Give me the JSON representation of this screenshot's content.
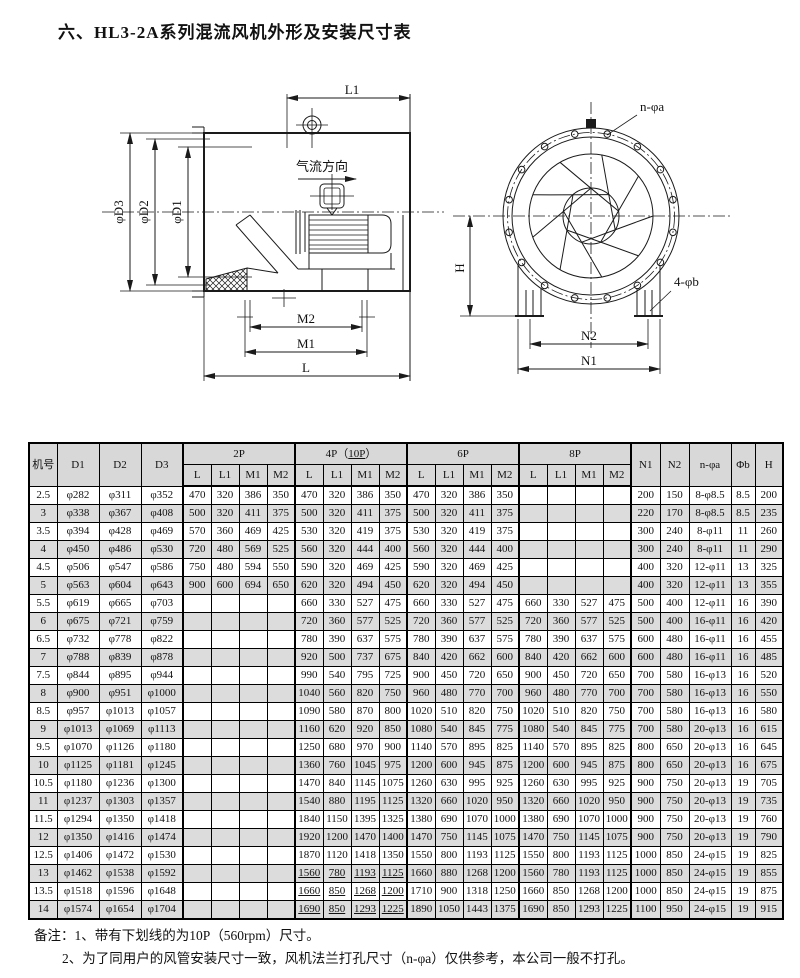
{
  "page": {
    "title": "六、HL3-2A系列混流风机外形及安装尺寸表"
  },
  "drawing": {
    "side_view": {
      "dim_l1": "L1",
      "airflow_label": "气流方向",
      "dim_d3": "φD3",
      "dim_d2": "φD2",
      "dim_d1": "φD1",
      "dim_m2": "M2",
      "dim_m1": "M1",
      "dim_l": "L"
    },
    "front_view": {
      "bolt_holes_label": "n-φa",
      "foot_holes_label": "4-φb",
      "dim_h": "H",
      "dim_n2": "N2",
      "dim_n1": "N1"
    }
  },
  "table": {
    "left_headers": [
      "机号",
      "D1",
      "D2",
      "D3"
    ],
    "groups": [
      {
        "label": "2P"
      },
      {
        "label": "4P（",
        "underline": "10P",
        "suffix": "）"
      },
      {
        "label": "6P"
      },
      {
        "label": "8P"
      }
    ],
    "sub_headers": [
      "L",
      "L1",
      "M1",
      "M2"
    ],
    "right_headers": [
      "N1",
      "N2",
      "n-φa",
      "Φb",
      "H"
    ],
    "underline_10p_rows": [
      "13",
      "13.5",
      "14"
    ],
    "rows": [
      [
        "2.5",
        "φ282",
        "φ311",
        "φ352",
        "470",
        "320",
        "386",
        "350",
        "470",
        "320",
        "386",
        "350",
        "470",
        "320",
        "386",
        "350",
        "",
        "",
        "",
        "",
        "200",
        "150",
        "8-φ8.5",
        "8.5",
        "200"
      ],
      [
        "3",
        "φ338",
        "φ367",
        "φ408",
        "500",
        "320",
        "411",
        "375",
        "500",
        "320",
        "411",
        "375",
        "500",
        "320",
        "411",
        "375",
        "",
        "",
        "",
        "",
        "220",
        "170",
        "8-φ8.5",
        "8.5",
        "235"
      ],
      [
        "3.5",
        "φ394",
        "φ428",
        "φ469",
        "570",
        "360",
        "469",
        "425",
        "530",
        "320",
        "419",
        "375",
        "530",
        "320",
        "419",
        "375",
        "",
        "",
        "",
        "",
        "300",
        "240",
        "8-φ11",
        "11",
        "260"
      ],
      [
        "4",
        "φ450",
        "φ486",
        "φ530",
        "720",
        "480",
        "569",
        "525",
        "560",
        "320",
        "444",
        "400",
        "560",
        "320",
        "444",
        "400",
        "",
        "",
        "",
        "",
        "300",
        "240",
        "8-φ11",
        "11",
        "290"
      ],
      [
        "4.5",
        "φ506",
        "φ547",
        "φ586",
        "750",
        "480",
        "594",
        "550",
        "590",
        "320",
        "469",
        "425",
        "590",
        "320",
        "469",
        "425",
        "",
        "",
        "",
        "",
        "400",
        "320",
        "12-φ11",
        "13",
        "325"
      ],
      [
        "5",
        "φ563",
        "φ604",
        "φ643",
        "900",
        "600",
        "694",
        "650",
        "620",
        "320",
        "494",
        "450",
        "620",
        "320",
        "494",
        "450",
        "",
        "",
        "",
        "",
        "400",
        "320",
        "12-φ11",
        "13",
        "355"
      ],
      [
        "5.5",
        "φ619",
        "φ665",
        "φ703",
        "",
        "",
        "",
        "",
        "660",
        "330",
        "527",
        "475",
        "660",
        "330",
        "527",
        "475",
        "660",
        "330",
        "527",
        "475",
        "500",
        "400",
        "12-φ11",
        "16",
        "390"
      ],
      [
        "6",
        "φ675",
        "φ721",
        "φ759",
        "",
        "",
        "",
        "",
        "720",
        "360",
        "577",
        "525",
        "720",
        "360",
        "577",
        "525",
        "720",
        "360",
        "577",
        "525",
        "500",
        "400",
        "16-φ11",
        "16",
        "420"
      ],
      [
        "6.5",
        "φ732",
        "φ778",
        "φ822",
        "",
        "",
        "",
        "",
        "780",
        "390",
        "637",
        "575",
        "780",
        "390",
        "637",
        "575",
        "780",
        "390",
        "637",
        "575",
        "600",
        "480",
        "16-φ11",
        "16",
        "455"
      ],
      [
        "7",
        "φ788",
        "φ839",
        "φ878",
        "",
        "",
        "",
        "",
        "920",
        "500",
        "737",
        "675",
        "840",
        "420",
        "662",
        "600",
        "840",
        "420",
        "662",
        "600",
        "600",
        "480",
        "16-φ11",
        "16",
        "485"
      ],
      [
        "7.5",
        "φ844",
        "φ895",
        "φ944",
        "",
        "",
        "",
        "",
        "990",
        "540",
        "795",
        "725",
        "900",
        "450",
        "720",
        "650",
        "900",
        "450",
        "720",
        "650",
        "700",
        "580",
        "16-φ13",
        "16",
        "520"
      ],
      [
        "8",
        "φ900",
        "φ951",
        "φ1000",
        "",
        "",
        "",
        "",
        "1040",
        "560",
        "820",
        "750",
        "960",
        "480",
        "770",
        "700",
        "960",
        "480",
        "770",
        "700",
        "700",
        "580",
        "16-φ13",
        "16",
        "550"
      ],
      [
        "8.5",
        "φ957",
        "φ1013",
        "φ1057",
        "",
        "",
        "",
        "",
        "1090",
        "580",
        "870",
        "800",
        "1020",
        "510",
        "820",
        "750",
        "1020",
        "510",
        "820",
        "750",
        "700",
        "580",
        "16-φ13",
        "16",
        "580"
      ],
      [
        "9",
        "φ1013",
        "φ1069",
        "φ1113",
        "",
        "",
        "",
        "",
        "1160",
        "620",
        "920",
        "850",
        "1080",
        "540",
        "845",
        "775",
        "1080",
        "540",
        "845",
        "775",
        "700",
        "580",
        "20-φ13",
        "16",
        "615"
      ],
      [
        "9.5",
        "φ1070",
        "φ1126",
        "φ1180",
        "",
        "",
        "",
        "",
        "1250",
        "680",
        "970",
        "900",
        "1140",
        "570",
        "895",
        "825",
        "1140",
        "570",
        "895",
        "825",
        "800",
        "650",
        "20-φ13",
        "16",
        "645"
      ],
      [
        "10",
        "φ1125",
        "φ1181",
        "φ1245",
        "",
        "",
        "",
        "",
        "1360",
        "760",
        "1045",
        "975",
        "1200",
        "600",
        "945",
        "875",
        "1200",
        "600",
        "945",
        "875",
        "800",
        "650",
        "20-φ13",
        "16",
        "675"
      ],
      [
        "10.5",
        "φ1180",
        "φ1236",
        "φ1300",
        "",
        "",
        "",
        "",
        "1470",
        "840",
        "1145",
        "1075",
        "1260",
        "630",
        "995",
        "925",
        "1260",
        "630",
        "995",
        "925",
        "900",
        "750",
        "20-φ13",
        "19",
        "705"
      ],
      [
        "11",
        "φ1237",
        "φ1303",
        "φ1357",
        "",
        "",
        "",
        "",
        "1540",
        "880",
        "1195",
        "1125",
        "1320",
        "660",
        "1020",
        "950",
        "1320",
        "660",
        "1020",
        "950",
        "900",
        "750",
        "20-φ13",
        "19",
        "735"
      ],
      [
        "11.5",
        "φ1294",
        "φ1350",
        "φ1418",
        "",
        "",
        "",
        "",
        "1840",
        "1150",
        "1395",
        "1325",
        "1380",
        "690",
        "1070",
        "1000",
        "1380",
        "690",
        "1070",
        "1000",
        "900",
        "750",
        "20-φ13",
        "19",
        "760"
      ],
      [
        "12",
        "φ1350",
        "φ1416",
        "φ1474",
        "",
        "",
        "",
        "",
        "1920",
        "1200",
        "1470",
        "1400",
        "1470",
        "750",
        "1145",
        "1075",
        "1470",
        "750",
        "1145",
        "1075",
        "900",
        "750",
        "20-φ13",
        "19",
        "790"
      ],
      [
        "12.5",
        "φ1406",
        "φ1472",
        "φ1530",
        "",
        "",
        "",
        "",
        "1870",
        "1120",
        "1418",
        "1350",
        "1550",
        "800",
        "1193",
        "1125",
        "1550",
        "800",
        "1193",
        "1125",
        "1000",
        "850",
        "24-φ15",
        "19",
        "825"
      ],
      [
        "13",
        "φ1462",
        "φ1538",
        "φ1592",
        "",
        "",
        "",
        "",
        "1560",
        "780",
        "1193",
        "1125",
        "1660",
        "880",
        "1268",
        "1200",
        "1560",
        "780",
        "1193",
        "1125",
        "1000",
        "850",
        "24-φ15",
        "19",
        "855"
      ],
      [
        "13.5",
        "φ1518",
        "φ1596",
        "φ1648",
        "",
        "",
        "",
        "",
        "1660",
        "850",
        "1268",
        "1200",
        "1710",
        "900",
        "1318",
        "1250",
        "1660",
        "850",
        "1268",
        "1200",
        "1000",
        "850",
        "24-φ15",
        "19",
        "875"
      ],
      [
        "14",
        "φ1574",
        "φ1654",
        "φ1704",
        "",
        "",
        "",
        "",
        "1690",
        "850",
        "1293",
        "1225",
        "1890",
        "1050",
        "1443",
        "1375",
        "1690",
        "850",
        "1293",
        "1225",
        "1100",
        "950",
        "24-φ15",
        "19",
        "915"
      ]
    ]
  },
  "notes": {
    "line1": "备注：1、带有下划线的为10P（560rpm）尺寸。",
    "line2": "2、为了同用户的风管安装尺寸一致，风机法兰打孔尺寸（n-φa）仅供参考，本公司一般不打孔。"
  },
  "colors": {
    "ink": "#1a1a1a",
    "header_shade": "#d8d8d8",
    "row_shade": "#dcdcdc"
  }
}
